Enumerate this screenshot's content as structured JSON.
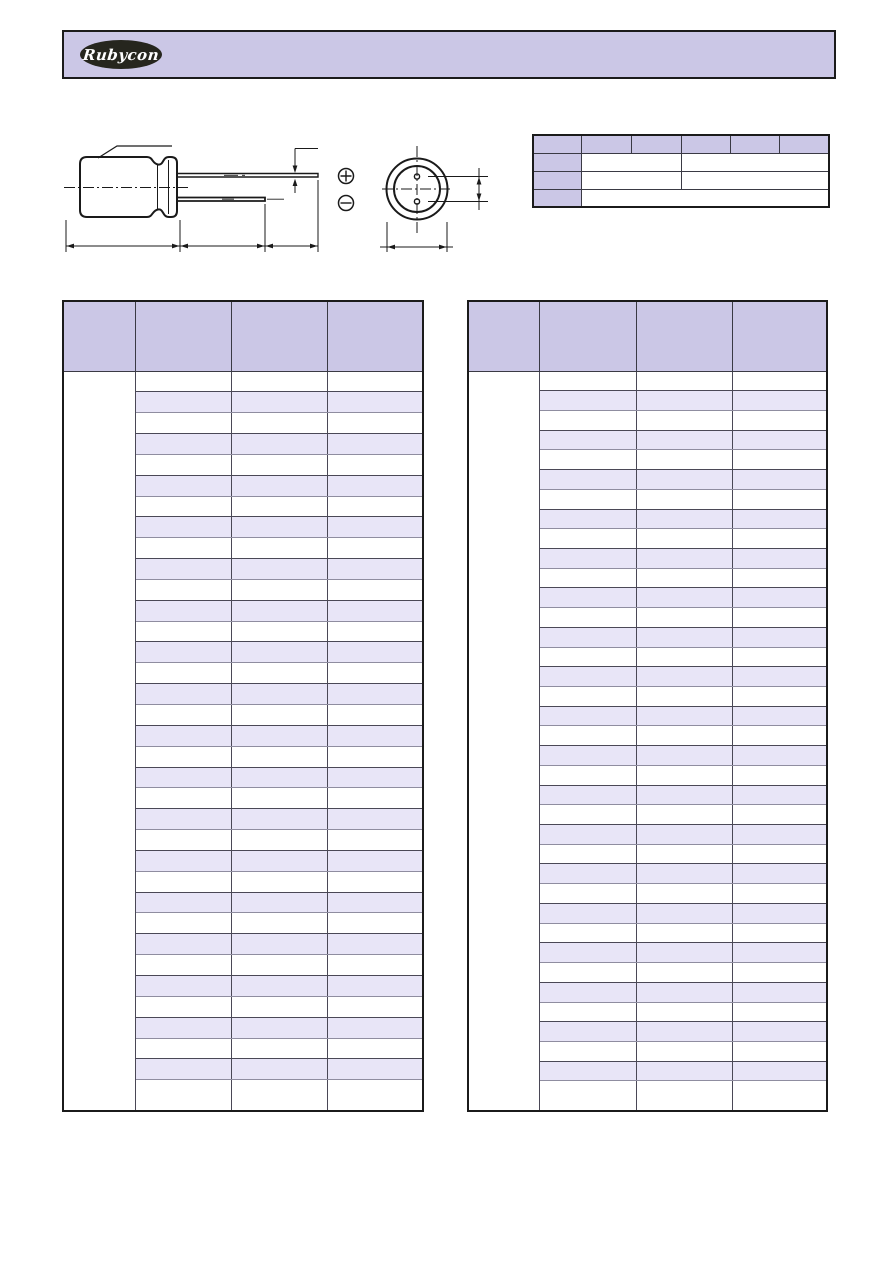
{
  "page": {
    "width": 893,
    "height": 1263,
    "background": "#ffffff"
  },
  "header": {
    "logo_text": "Rubycon",
    "banner_color": "#cbc7e6",
    "logo_background": "#26261e",
    "logo_text_color": "#ffffff"
  },
  "colors": {
    "header_purple": "#cbc7e6",
    "stripe_purple": "#e8e5f7",
    "border_dark": "#1b1b1b",
    "border_gray": "#8f8da0",
    "line_color": "#1a1a1a"
  },
  "drawing": {
    "description": "Dimension outline drawing of radial-lead electrolytic capacitor: side view with sleeve callout, two leads, dimension chain, and bottom view with lead-hole spacing",
    "icons": {
      "polarity_positive": "circled-plus",
      "polarity_negative": "circled-minus"
    },
    "polarity_positive_symbol": "⊕",
    "polarity_negative_symbol": "⊖"
  },
  "spec_table": {
    "x": 532,
    "y": 134,
    "width": 296,
    "height": 72,
    "col_widths": [
      48,
      50,
      50,
      49,
      49,
      50
    ],
    "row_height": 18,
    "rows": [
      {
        "cells": [
          {
            "span": 1,
            "hdr": true
          },
          {
            "span": 1,
            "hdr": true
          },
          {
            "span": 1,
            "hdr": true
          },
          {
            "span": 1,
            "hdr": true
          },
          {
            "span": 1,
            "hdr": true
          },
          {
            "span": 1,
            "hdr": true
          }
        ]
      },
      {
        "cells": [
          {
            "span": 1,
            "hdr": true
          },
          {
            "span": 2,
            "hdr": false
          },
          {
            "span": 3,
            "hdr": false
          }
        ]
      },
      {
        "cells": [
          {
            "span": 1,
            "hdr": true
          },
          {
            "span": 2,
            "hdr": false
          },
          {
            "span": 3,
            "hdr": false
          }
        ]
      },
      {
        "cells": [
          {
            "span": 1,
            "hdr": true
          },
          {
            "span": 5,
            "hdr": false
          }
        ]
      }
    ],
    "cell_text": ""
  },
  "left_table": {
    "x": 62,
    "y": 300,
    "width": 360,
    "total_height": 812,
    "header_height": 70,
    "col_widths": [
      72,
      96,
      96,
      96
    ],
    "column_count": 4,
    "data_row_count": 35,
    "first_column_merged": true,
    "stripe_pattern": "white/purple alternating starting white",
    "cell_text": ""
  },
  "right_table": {
    "x": 467,
    "y": 300,
    "width": 359,
    "total_height": 812,
    "header_height": 70,
    "col_widths": [
      71,
      97,
      96,
      95
    ],
    "column_count": 4,
    "data_row_count": 37,
    "first_column_merged": true,
    "stripe_pattern": "white/purple alternating starting white",
    "cell_text": ""
  }
}
